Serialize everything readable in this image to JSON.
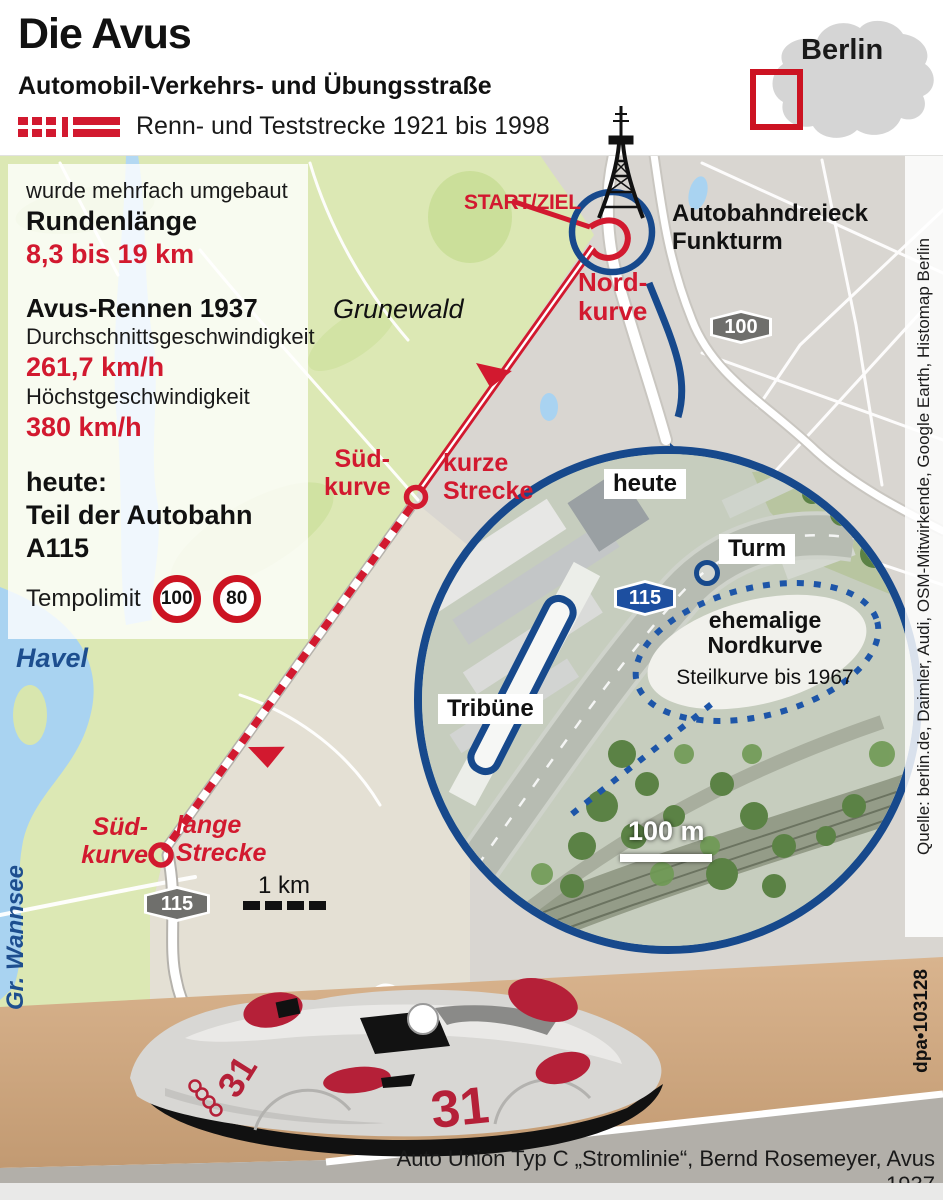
{
  "colors": {
    "accent_red": "#d2192f",
    "accent_blue": "#17498c",
    "sign_red": "#cc1322",
    "water": "#a9d3f1",
    "forest_green": "#dce8b4"
  },
  "header": {
    "title": "Die Avus",
    "subtitle": "Automobil-Verkehrs- und Übungsstraße",
    "legend_label": "Renn- und Teststrecke 1921 bis 1998",
    "berlin_inset_label": "Berlin"
  },
  "infobox": {
    "intro": "wurde mehrfach umgebaut",
    "lap_label": "Rundenlänge",
    "lap_value": "8,3 bis 19 km",
    "race_title": "Avus-Rennen 1937",
    "avg_label": "Durchschnittsgeschwindigkeit",
    "avg_value": "261,7 km/h",
    "top_label": "Höchstgeschwindigkeit",
    "top_value": "380 km/h",
    "today_label": "heute:",
    "today_value": "Teil der Autobahn A115",
    "tempo_label": "Tempolimit",
    "tempo_limit_1": "100",
    "tempo_limit_2": "80"
  },
  "map": {
    "start_ziel": "START/ZIEL",
    "junction": "Autobahndreieck\nFunkturm",
    "nordkurve": "Nord-\nkurve",
    "grunewald": "Grunewald",
    "suedkurve_nord": "Süd-\nkurve",
    "kurze_strecke": "kurze\nStrecke",
    "suedkurve_sued": "Süd-\nkurve",
    "lange_strecke": "lange\nStrecke",
    "havel": "Havel",
    "wannsee": "Gr. Wannsee",
    "badge_a100": "100",
    "badge_a115": "115",
    "scale_label": "1 km"
  },
  "inset": {
    "heute": "heute",
    "turm": "Turm",
    "badge_a115": "115",
    "ehemalige": "ehemalige\nNordkurve",
    "steilkurve": "Steilkurve bis 1967",
    "tribuene": "Tribüne",
    "scale_label": "100 m"
  },
  "car": {
    "number": "31",
    "caption": "Auto Union Typ C „Stromlinie“, Bernd Rosemeyer, Avus 1937"
  },
  "credits": {
    "source": "Quelle: berlin.de, Daimler, Audi, OSM-Mitwirkende, Google Earth, Histomap Berlin",
    "dpa_id": "dpa•103128"
  }
}
